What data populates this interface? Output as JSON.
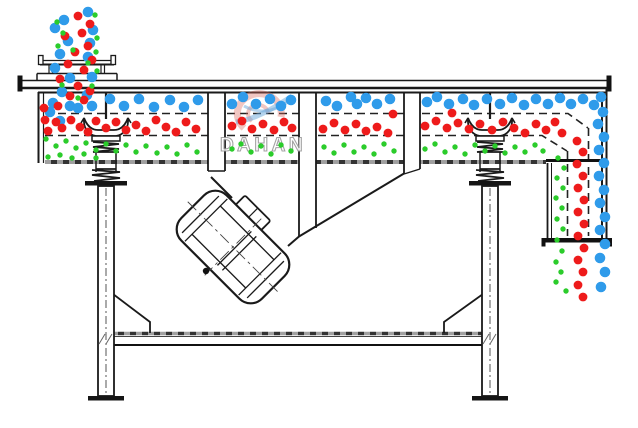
{
  "watermark": {
    "brand": "DAHAN",
    "registered_mark": "®",
    "text_color": "#9a9a9a",
    "logo_red": "#d96a5f",
    "logo_blue": "#6aa8dc"
  },
  "colors": {
    "line": "#1a1a1a",
    "hatch_dark": "#333333",
    "hatch_light": "#a0a0a0",
    "coarse_particle": "#2f9bea",
    "medium_particle": "#ee1b1b",
    "fine_particle": "#2bcc2b"
  },
  "particles": {
    "coarse_blue": {
      "color": "#2f9bea",
      "radius": 5.3,
      "points": [
        88,
        12,
        64,
        20,
        93,
        30,
        55,
        28,
        68,
        41,
        90,
        43,
        60,
        54,
        88,
        57,
        55,
        68,
        70,
        78,
        92,
        77,
        62,
        92,
        87,
        95,
        53,
        103,
        70,
        106,
        92,
        106,
        50,
        112,
        60,
        121,
        78,
        108,
        110,
        99,
        124,
        106,
        139,
        99,
        154,
        107,
        170,
        100,
        184,
        107,
        198,
        100,
        232,
        104,
        243,
        97,
        256,
        104,
        270,
        99,
        281,
        106,
        291,
        100,
        326,
        101,
        337,
        106,
        351,
        97,
        357,
        104,
        366,
        98,
        377,
        104,
        390,
        99,
        427,
        102,
        437,
        97,
        449,
        104,
        463,
        99,
        474,
        105,
        487,
        99,
        500,
        104,
        512,
        98,
        524,
        105,
        536,
        99,
        548,
        104,
        560,
        98,
        571,
        104,
        583,
        99,
        594,
        105,
        601,
        97,
        603,
        112,
        598,
        124,
        604,
        137,
        599,
        150,
        604,
        163,
        599,
        176,
        604,
        190,
        600,
        203,
        605,
        217,
        600,
        230,
        605,
        244,
        600,
        258,
        605,
        272,
        601,
        287
      ]
    },
    "medium_red": {
      "color": "#ee1b1b",
      "radius": 4.4,
      "points": [
        78,
        16,
        90,
        24,
        82,
        33,
        65,
        36,
        88,
        46,
        75,
        52,
        92,
        60,
        68,
        64,
        84,
        70,
        60,
        79,
        78,
        86,
        90,
        91,
        70,
        96,
        84,
        100,
        44,
        108,
        58,
        106,
        45,
        120,
        56,
        122,
        48,
        131,
        62,
        128,
        71,
        120,
        80,
        127,
        88,
        132,
        96,
        121,
        106,
        128,
        116,
        122,
        126,
        130,
        136,
        125,
        146,
        131,
        156,
        120,
        166,
        127,
        176,
        132,
        186,
        122,
        196,
        129,
        232,
        126,
        242,
        121,
        252,
        129,
        263,
        124,
        274,
        130,
        284,
        122,
        292,
        128,
        323,
        129,
        334,
        123,
        345,
        130,
        356,
        124,
        366,
        131,
        377,
        127,
        388,
        133,
        393,
        114,
        425,
        126,
        436,
        121,
        447,
        128,
        458,
        123,
        469,
        129,
        480,
        124,
        452,
        113,
        492,
        130,
        503,
        122,
        514,
        128,
        525,
        133,
        536,
        124,
        546,
        130,
        555,
        122,
        562,
        133,
        577,
        141,
        583,
        152,
        577,
        164,
        583,
        176,
        578,
        188,
        584,
        200,
        578,
        212,
        584,
        224,
        578,
        236,
        584,
        248,
        578,
        260,
        583,
        272,
        578,
        285,
        583,
        297
      ]
    },
    "fine_green": {
      "color": "#2bcc2b",
      "radius": 2.7,
      "points": [
        95,
        15,
        57,
        22,
        97,
        38,
        63,
        33,
        58,
        46,
        96,
        52,
        73,
        50,
        88,
        63,
        97,
        71,
        62,
        85,
        92,
        86,
        78,
        98,
        46,
        139,
        56,
        146,
        66,
        141,
        76,
        148,
        86,
        143,
        96,
        150,
        106,
        144,
        116,
        151,
        126,
        145,
        136,
        152,
        146,
        146,
        157,
        153,
        167,
        147,
        177,
        154,
        187,
        145,
        197,
        152,
        48,
        157,
        60,
        155,
        72,
        158,
        84,
        154,
        96,
        158,
        232,
        149,
        241,
        144,
        251,
        152,
        261,
        146,
        271,
        154,
        281,
        145,
        291,
        151,
        324,
        147,
        334,
        153,
        344,
        145,
        354,
        152,
        364,
        147,
        374,
        154,
        384,
        144,
        394,
        151,
        425,
        149,
        435,
        144,
        445,
        152,
        455,
        147,
        465,
        154,
        475,
        145,
        485,
        151,
        495,
        146,
        505,
        153,
        515,
        147,
        525,
        152,
        535,
        145,
        543,
        151,
        558,
        158,
        564,
        168,
        557,
        178,
        563,
        188,
        556,
        198,
        562,
        208,
        557,
        219,
        563,
        229,
        557,
        240,
        562,
        251,
        556,
        262,
        561,
        272,
        556,
        282,
        566,
        291
      ]
    }
  }
}
